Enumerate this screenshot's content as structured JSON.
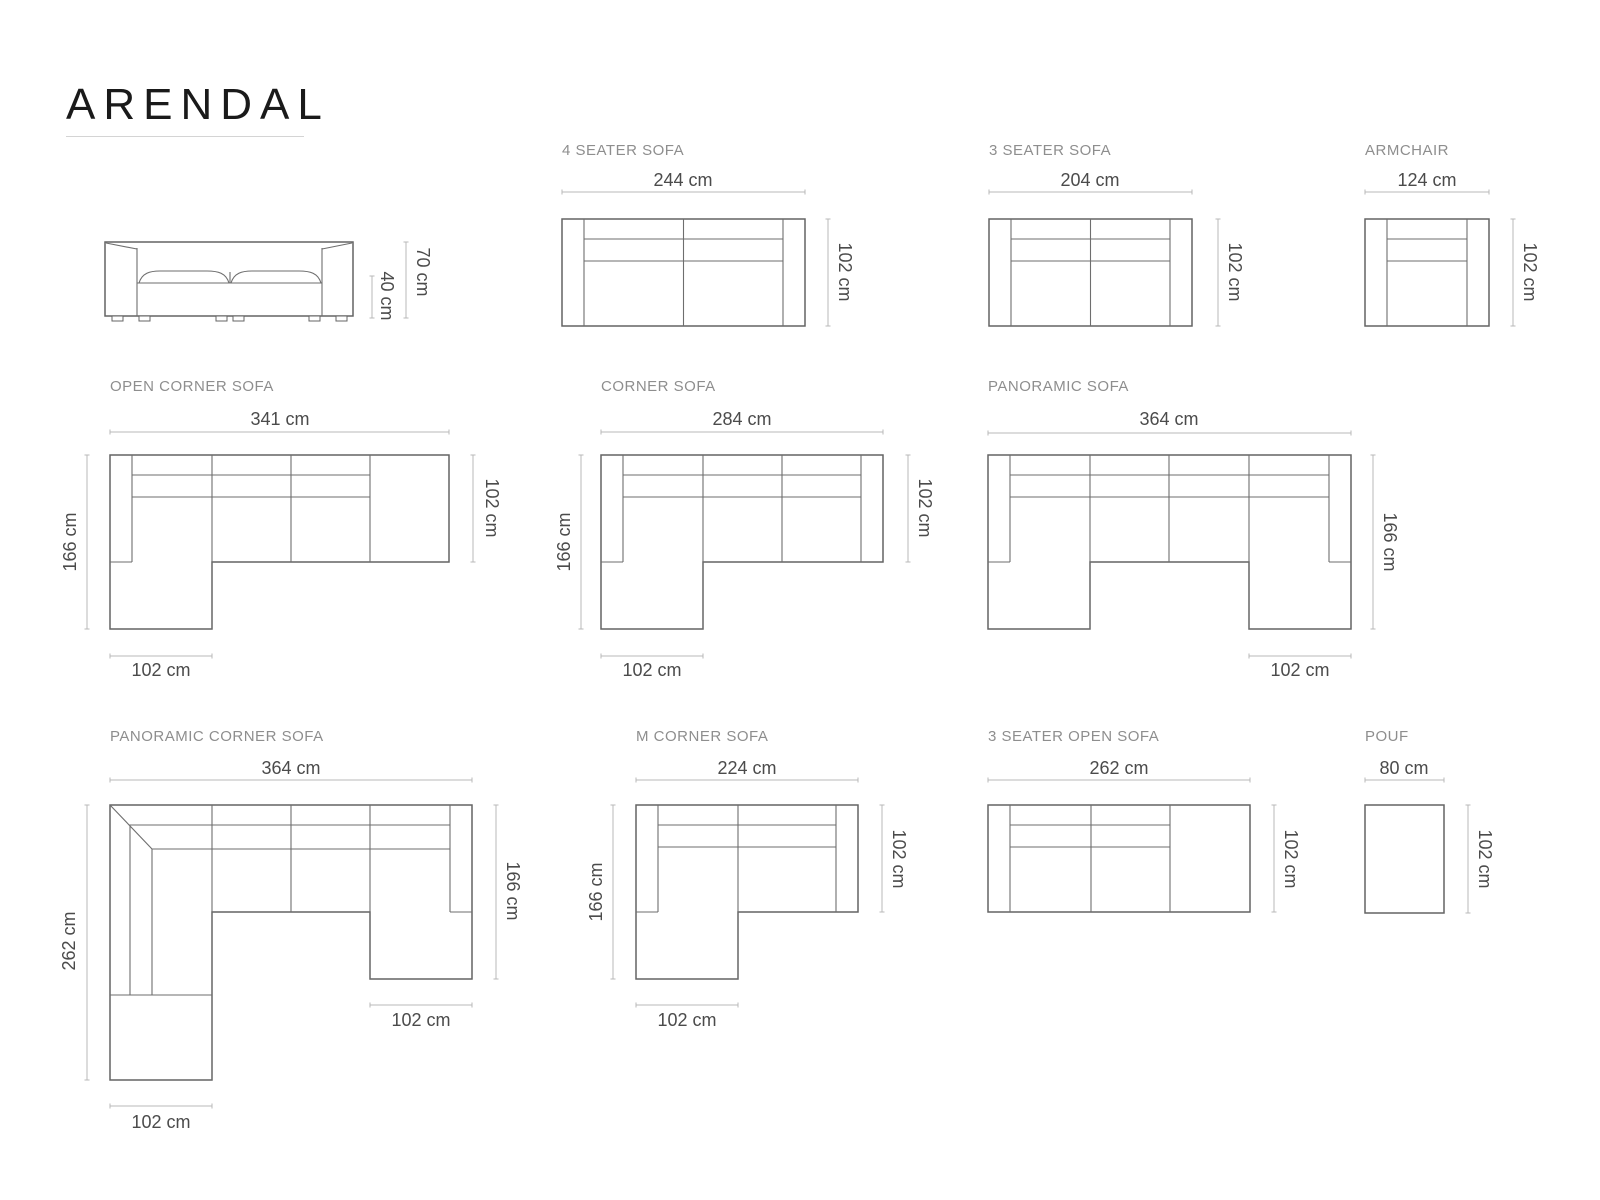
{
  "title": "ARENDAL",
  "products": {
    "sofa_front": {
      "height": "70 cm",
      "seat_height": "40 cm"
    },
    "four_seater": {
      "label": "4 SEATER SOFA",
      "width": "244 cm",
      "depth": "102 cm"
    },
    "three_seater": {
      "label": "3 SEATER SOFA",
      "width": "204 cm",
      "depth": "102 cm"
    },
    "armchair": {
      "label": "ARMCHAIR",
      "width": "124 cm",
      "depth": "102 cm"
    },
    "open_corner": {
      "label": "OPEN CORNER SOFA",
      "width": "341 cm",
      "depth": "166 cm",
      "side": "102 cm",
      "chaise": "102 cm"
    },
    "corner": {
      "label": "CORNER SOFA",
      "width": "284 cm",
      "depth": "166 cm",
      "side": "102 cm",
      "chaise": "102 cm"
    },
    "panoramic": {
      "label": "PANORAMIC SOFA",
      "width": "364 cm",
      "depth": "166 cm",
      "chaise": "102 cm"
    },
    "panoramic_corner": {
      "label": "PANORAMIC CORNER SOFA",
      "width": "364 cm",
      "left_depth": "262 cm",
      "right_depth": "166 cm",
      "right_chaise": "102 cm",
      "bottom_chaise": "102 cm"
    },
    "m_corner": {
      "label": "M CORNER SOFA",
      "width": "224 cm",
      "depth": "166 cm",
      "side": "102 cm",
      "chaise": "102 cm"
    },
    "three_seater_open": {
      "label": "3 SEATER OPEN SOFA",
      "width": "262 cm",
      "depth": "102 cm"
    },
    "pouf": {
      "label": "POUF",
      "width": "80 cm",
      "depth": "102 cm"
    }
  }
}
